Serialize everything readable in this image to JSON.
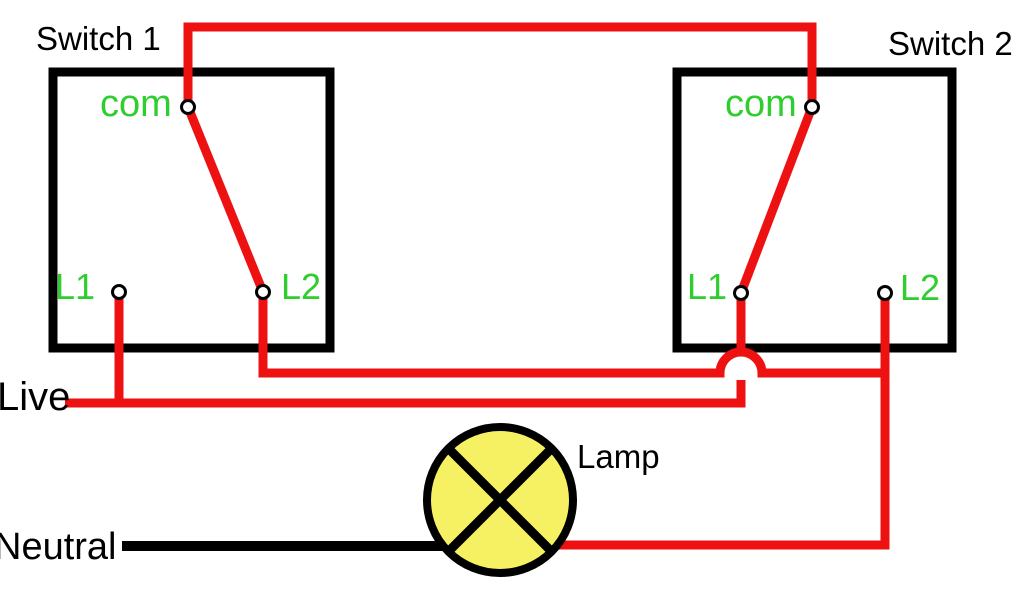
{
  "diagram": {
    "switch1": {
      "title": "Switch 1",
      "com_label": "com",
      "l1_label": "L1",
      "l2_label": "L2"
    },
    "switch2": {
      "title": "Switch 2",
      "com_label": "com",
      "l1_label": "L1",
      "l2_label": "L2"
    },
    "live_label": "Live",
    "neutral_label": "Neutral",
    "lamp_label": "Lamp"
  },
  "colors": {
    "wire_red": "#ee1111",
    "wire_black": "#000000",
    "label_green": "#2dce2d",
    "lamp_yellow": "#f5f163",
    "text_black": "#000000",
    "background": "#ffffff"
  }
}
